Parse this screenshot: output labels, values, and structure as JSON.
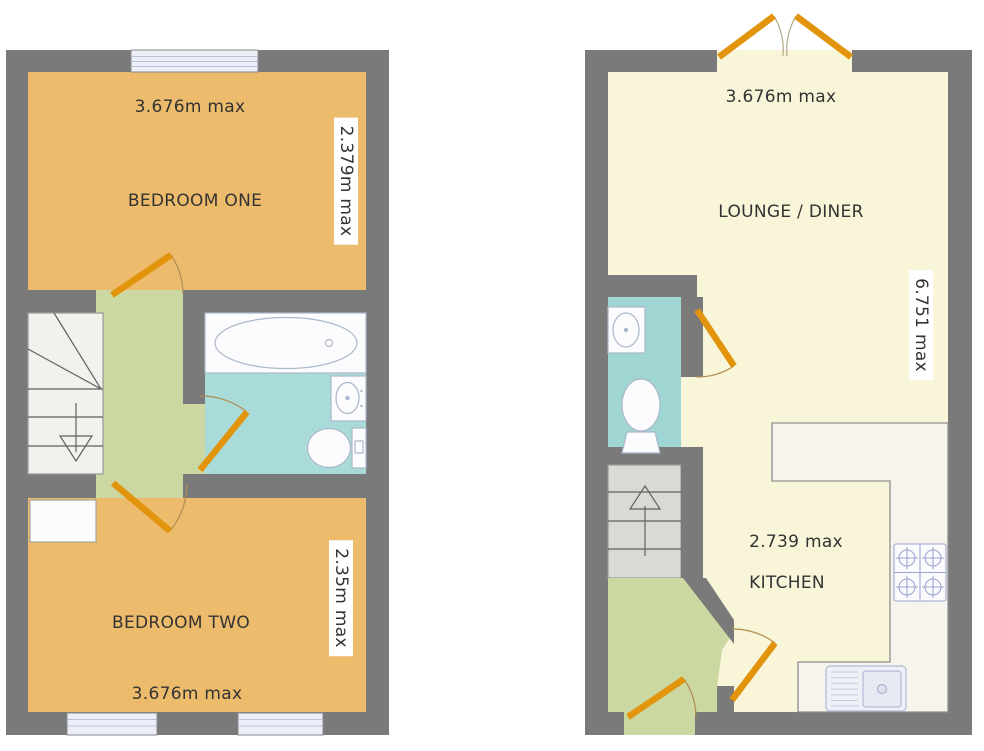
{
  "document": {
    "type": "floorplan",
    "background": "#ffffff"
  },
  "colors": {
    "wall": "#7a7a7a",
    "bedroom": "#ecbb6c",
    "hall": "#cbd8a2",
    "bathroom": "#a9dcd8",
    "wc": "#9fd6d3",
    "lounge": "#f8f5d8",
    "stairs_first_floor": "#f1f1ee",
    "stairs_ground_floor": "#d9d9d5",
    "door": "#e2940c",
    "window_glass": "#eceff8",
    "kitchen_counter": "#f7f4ed",
    "fixture_outline": "#aab7cb",
    "text": "#333333"
  },
  "first_floor": {
    "bedroom_one": {
      "name": "BEDROOM ONE",
      "width": "3.676m max",
      "depth": "2.379m max"
    },
    "bedroom_two": {
      "name": "BEDROOM TWO",
      "width": "3.676m max",
      "depth": "2.35m max"
    }
  },
  "ground_floor": {
    "lounge_diner": {
      "name": "LOUNGE / DINER",
      "width": "3.676m max",
      "depth": "6.751 max"
    },
    "kitchen": {
      "name": "KITCHEN",
      "width": "2.739 max"
    }
  }
}
